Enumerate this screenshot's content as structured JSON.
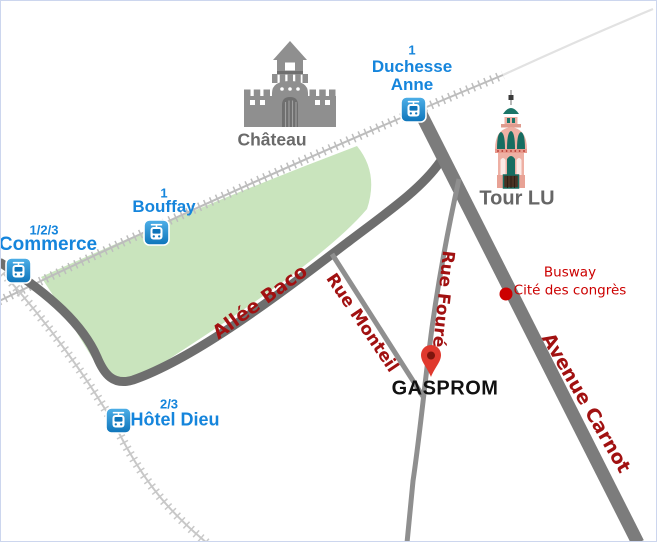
{
  "map": {
    "stops": {
      "commerce": {
        "lines": "1/2/3",
        "name": "Commerce"
      },
      "bouffay": {
        "lines": "1",
        "name": "Bouffay"
      },
      "duchesse_anne": {
        "lines": "1",
        "name": "Duchesse Anne"
      },
      "hotel_dieu": {
        "lines": "2/3",
        "name": "Hôtel Dieu"
      }
    },
    "streets": {
      "allee_baco": "Allée Baco",
      "rue_monteil": "Rue Monteil",
      "rue_foure": "Rue Fouré",
      "avenue_carnot": "Avenue Carnot"
    },
    "landmarks": {
      "chateau": "Château",
      "tour_lu": "Tour LU"
    },
    "busway": {
      "line1": "Busway",
      "line2": "Cité des congrès"
    },
    "destination": "GASPROM",
    "icons": [
      "tram-icon",
      "map-pin-icon",
      "busway-stop-icon",
      "chateau-icon",
      "tour-lu-icon",
      "railway-track"
    ],
    "colors": {
      "tram_blue": "#1585dc",
      "street_red": "#a11111",
      "busway_red": "#cc0000",
      "park_green": "#c9e4bd",
      "road_gray": "#757575",
      "pin_red": "#e0392e"
    }
  }
}
